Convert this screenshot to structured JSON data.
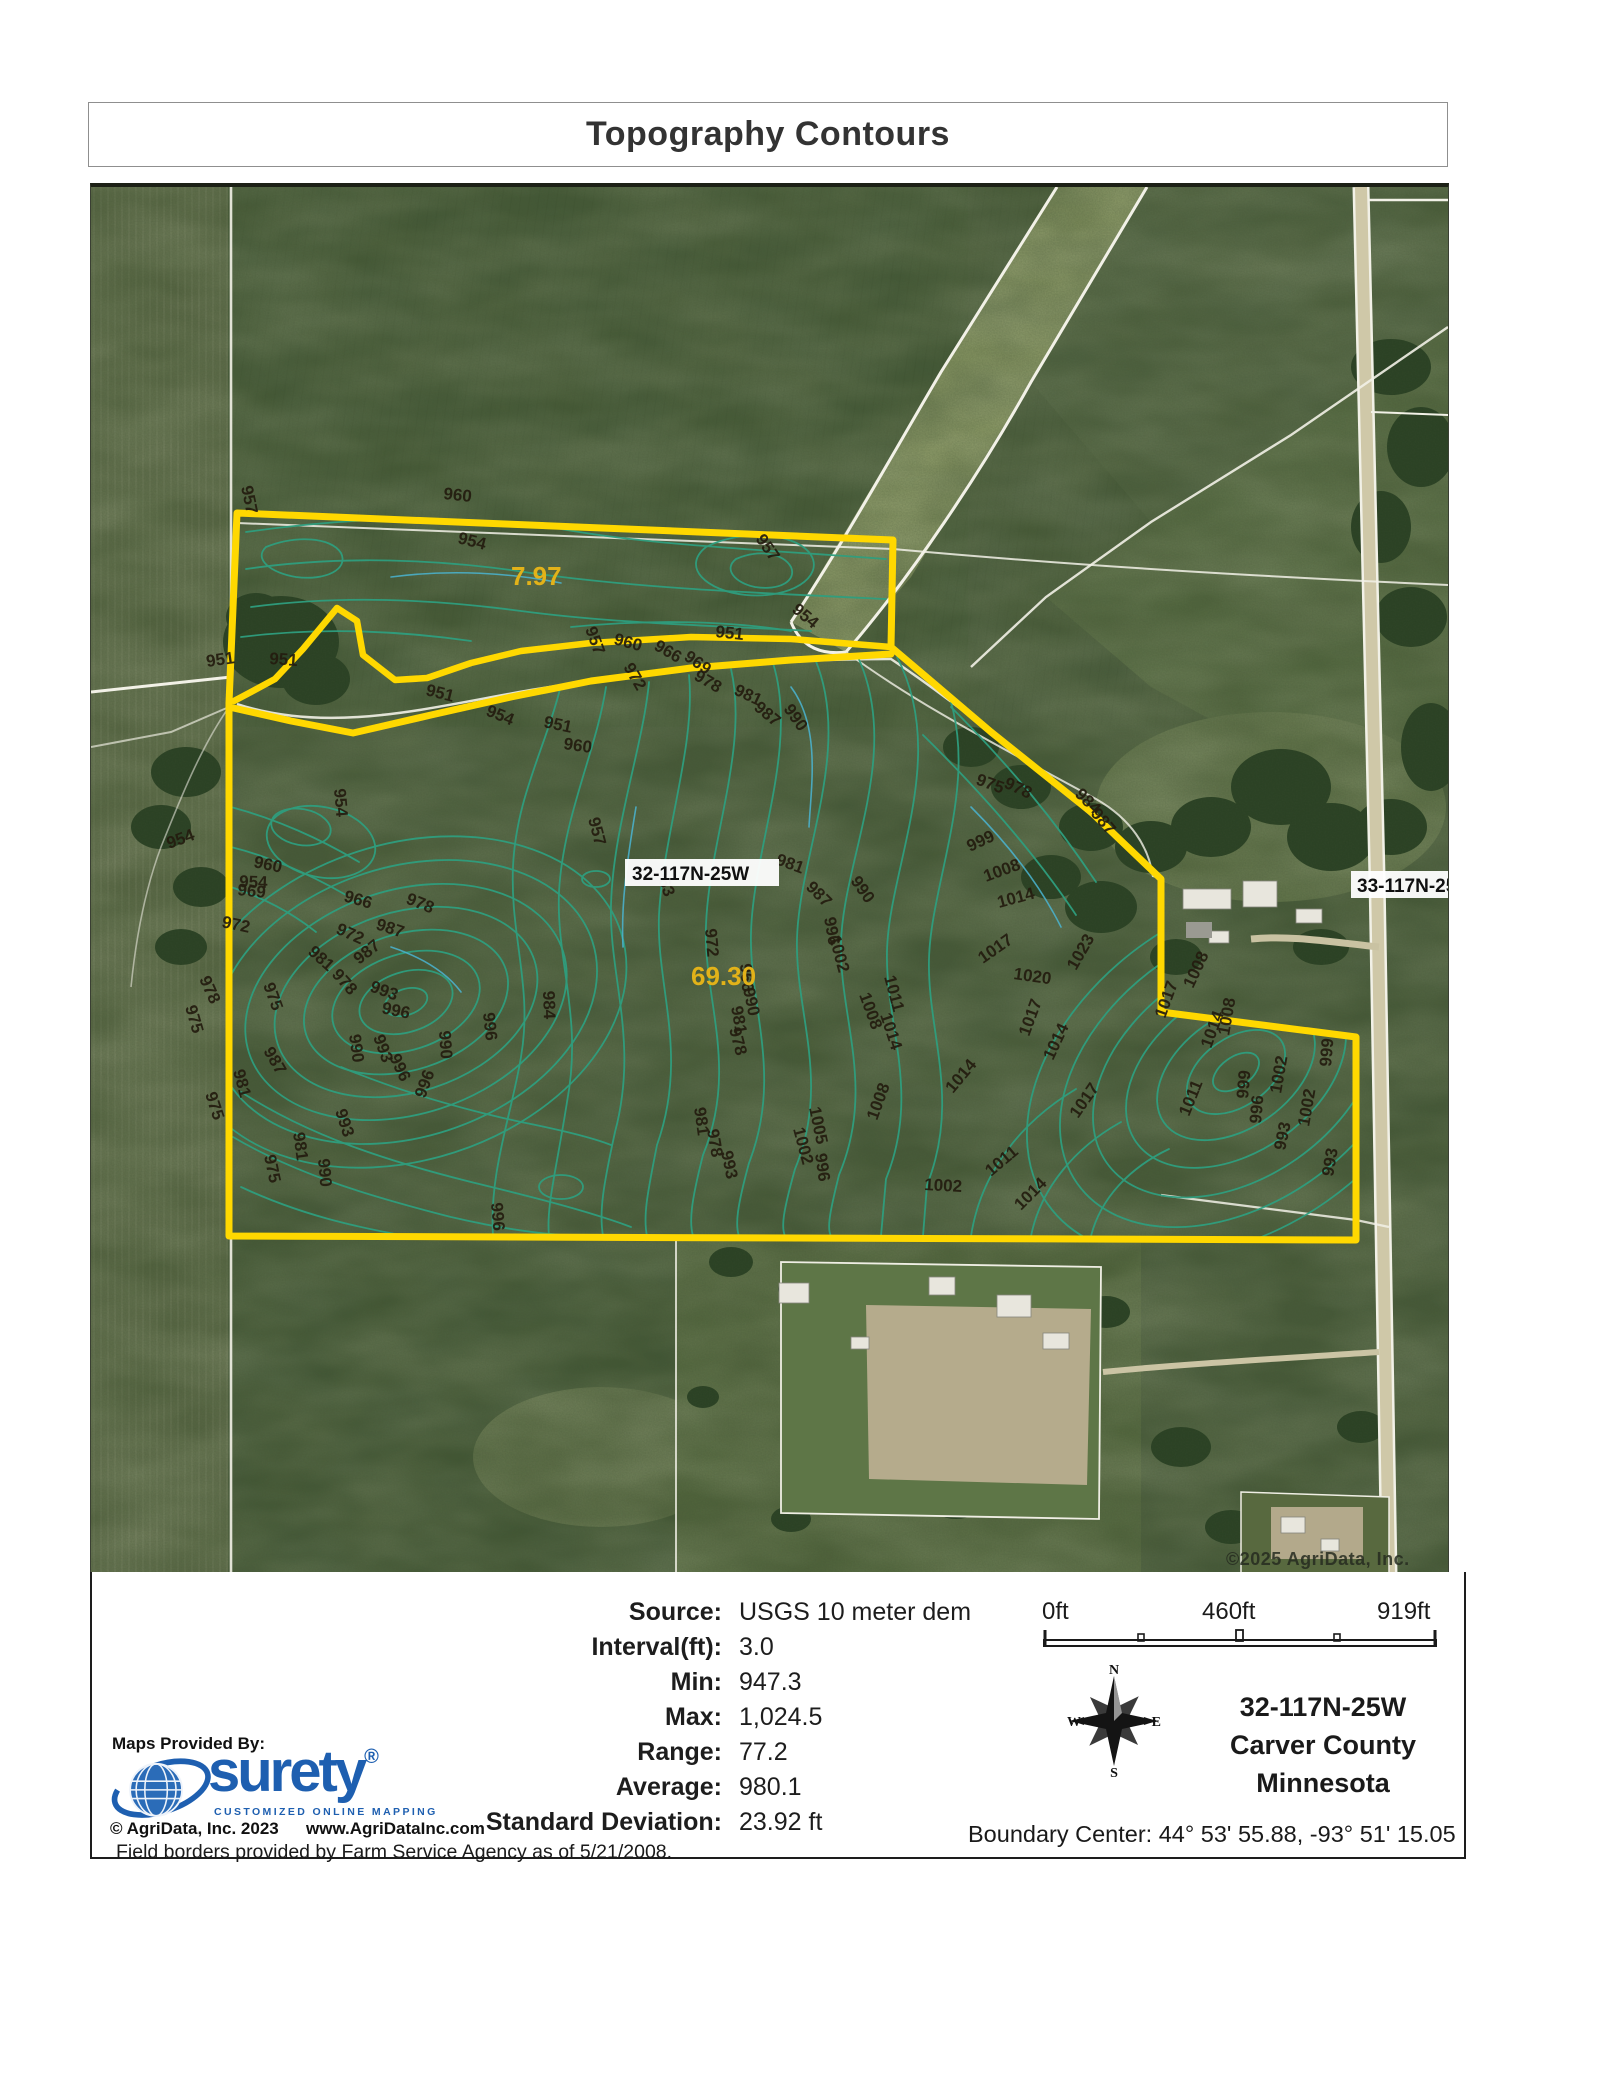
{
  "page": {
    "title": "Topography Contours"
  },
  "map": {
    "labels": {
      "township_left": "32-117N-25W",
      "township_right": "33-117N-25W",
      "copyright": "©2025 AgriData, Inc."
    },
    "parcels": [
      {
        "acres": "7.97"
      },
      {
        "acres": "69.30"
      }
    ],
    "contour_labels": [
      {
        "t": "957",
        "x": 150,
        "y": 300,
        "r": 78
      },
      {
        "t": "960",
        "x": 352,
        "y": 312,
        "r": 6
      },
      {
        "t": "954",
        "x": 366,
        "y": 356,
        "r": 14
      },
      {
        "t": "957",
        "x": 664,
        "y": 352,
        "r": 55
      },
      {
        "t": "954",
        "x": 700,
        "y": 424,
        "r": 40
      },
      {
        "t": "951",
        "x": 624,
        "y": 450,
        "r": 6
      },
      {
        "t": "951",
        "x": 116,
        "y": 480,
        "r": -8
      },
      {
        "t": "951",
        "x": 178,
        "y": 477,
        "r": 4
      },
      {
        "t": "951",
        "x": 334,
        "y": 508,
        "r": 14
      },
      {
        "t": "954",
        "x": 394,
        "y": 528,
        "r": 22
      },
      {
        "t": "951",
        "x": 452,
        "y": 540,
        "r": 12
      },
      {
        "t": "954",
        "x": 243,
        "y": 602,
        "r": 85
      },
      {
        "t": "954",
        "x": 148,
        "y": 700,
        "r": 2
      },
      {
        "t": "954",
        "x": 78,
        "y": 662,
        "r": -20
      },
      {
        "t": "960",
        "x": 162,
        "y": 680,
        "r": 12
      },
      {
        "t": "969",
        "x": 146,
        "y": 708,
        "r": 6
      },
      {
        "t": "972",
        "x": 130,
        "y": 740,
        "r": 12
      },
      {
        "t": "966",
        "x": 252,
        "y": 714,
        "r": 16
      },
      {
        "t": "978",
        "x": 314,
        "y": 716,
        "r": 22
      },
      {
        "t": "972",
        "x": 244,
        "y": 746,
        "r": 24
      },
      {
        "t": "987",
        "x": 284,
        "y": 742,
        "r": 18
      },
      {
        "t": "981",
        "x": 216,
        "y": 766,
        "r": 42
      },
      {
        "t": "978",
        "x": 240,
        "y": 788,
        "r": 48
      },
      {
        "t": "975",
        "x": 172,
        "y": 798,
        "r": 70
      },
      {
        "t": "987",
        "x": 268,
        "y": 778,
        "r": -38
      },
      {
        "t": "993",
        "x": 278,
        "y": 804,
        "r": 20
      },
      {
        "t": "996",
        "x": 290,
        "y": 826,
        "r": 12
      },
      {
        "t": "975",
        "x": 94,
        "y": 820,
        "r": 74
      },
      {
        "t": "978",
        "x": 108,
        "y": 792,
        "r": 66
      },
      {
        "t": "990",
        "x": 258,
        "y": 848,
        "r": 82
      },
      {
        "t": "993",
        "x": 282,
        "y": 850,
        "r": 70
      },
      {
        "t": "996",
        "x": 298,
        "y": 870,
        "r": 65
      },
      {
        "t": "984",
        "x": 452,
        "y": 804,
        "r": 88
      },
      {
        "t": "996",
        "x": 392,
        "y": 826,
        "r": 84
      },
      {
        "t": "990",
        "x": 348,
        "y": 844,
        "r": 86
      },
      {
        "t": "975",
        "x": 114,
        "y": 907,
        "r": 72
      },
      {
        "t": "981",
        "x": 142,
        "y": 884,
        "r": 75
      },
      {
        "t": "987",
        "x": 172,
        "y": 864,
        "r": 60
      },
      {
        "t": "996",
        "x": 334,
        "y": 912,
        "r": -70
      },
      {
        "t": "981",
        "x": 202,
        "y": 946,
        "r": 82
      },
      {
        "t": "975",
        "x": 173,
        "y": 969,
        "r": 78
      },
      {
        "t": "990",
        "x": 227,
        "y": 972,
        "r": 85
      },
      {
        "t": "993",
        "x": 244,
        "y": 924,
        "r": 72
      },
      {
        "t": "996",
        "x": 400,
        "y": 1016,
        "r": 85
      },
      {
        "t": "957",
        "x": 494,
        "y": 442,
        "r": 70
      },
      {
        "t": "960",
        "x": 522,
        "y": 457,
        "r": 15
      },
      {
        "t": "966",
        "x": 562,
        "y": 462,
        "r": 30
      },
      {
        "t": "969",
        "x": 592,
        "y": 472,
        "r": 35
      },
      {
        "t": "972",
        "x": 532,
        "y": 480,
        "r": 60
      },
      {
        "t": "978",
        "x": 602,
        "y": 492,
        "r": 30
      },
      {
        "t": "981",
        "x": 642,
        "y": 507,
        "r": 25
      },
      {
        "t": "987",
        "x": 662,
        "y": 522,
        "r": 40
      },
      {
        "t": "990",
        "x": 692,
        "y": 522,
        "r": 55
      },
      {
        "t": "963",
        "x": 564,
        "y": 684,
        "r": 70
      },
      {
        "t": "957",
        "x": 497,
        "y": 632,
        "r": 75
      },
      {
        "t": "960",
        "x": 472,
        "y": 562,
        "r": 8
      },
      {
        "t": "972",
        "x": 614,
        "y": 742,
        "r": 85
      },
      {
        "t": "996",
        "x": 733,
        "y": 731,
        "r": 80
      },
      {
        "t": "1002",
        "x": 738,
        "y": 750,
        "r": 75
      },
      {
        "t": "981",
        "x": 684,
        "y": 677,
        "r": 20
      },
      {
        "t": "987",
        "x": 714,
        "y": 701,
        "r": 45
      },
      {
        "t": "990",
        "x": 759,
        "y": 694,
        "r": 55
      },
      {
        "t": "966",
        "x": 649,
        "y": 777,
        "r": 85
      },
      {
        "t": "990",
        "x": 652,
        "y": 802,
        "r": 78
      },
      {
        "t": "981",
        "x": 640,
        "y": 820,
        "r": 80
      },
      {
        "t": "978",
        "x": 638,
        "y": 842,
        "r": 75
      },
      {
        "t": "975",
        "x": 884,
        "y": 597,
        "r": 20
      },
      {
        "t": "978",
        "x": 912,
        "y": 600,
        "r": 25
      },
      {
        "t": "984",
        "x": 983,
        "y": 608,
        "r": 45
      },
      {
        "t": "987",
        "x": 999,
        "y": 627,
        "r": 50
      },
      {
        "t": "999",
        "x": 879,
        "y": 665,
        "r": -25
      },
      {
        "t": "1008",
        "x": 895,
        "y": 695,
        "r": -20
      },
      {
        "t": "1014",
        "x": 908,
        "y": 721,
        "r": -15
      },
      {
        "t": "1011",
        "x": 793,
        "y": 790,
        "r": 75
      },
      {
        "t": "1008",
        "x": 768,
        "y": 808,
        "r": 70
      },
      {
        "t": "1014",
        "x": 789,
        "y": 828,
        "r": 72
      },
      {
        "t": "1017",
        "x": 892,
        "y": 777,
        "r": -35
      },
      {
        "t": "1020",
        "x": 922,
        "y": 792,
        "r": 8
      },
      {
        "t": "1023",
        "x": 985,
        "y": 784,
        "r": -60
      },
      {
        "t": "1017",
        "x": 938,
        "y": 850,
        "r": -70
      },
      {
        "t": "1014",
        "x": 962,
        "y": 874,
        "r": -65
      },
      {
        "t": "1005",
        "x": 718,
        "y": 921,
        "r": 78
      },
      {
        "t": "1002",
        "x": 702,
        "y": 942,
        "r": 75
      },
      {
        "t": "1008",
        "x": 786,
        "y": 934,
        "r": -70
      },
      {
        "t": "1014",
        "x": 862,
        "y": 907,
        "r": -50
      },
      {
        "t": "1002",
        "x": 833,
        "y": 1003,
        "r": 3
      },
      {
        "t": "996",
        "x": 724,
        "y": 967,
        "r": 82
      },
      {
        "t": "993",
        "x": 630,
        "y": 965,
        "r": 78
      },
      {
        "t": "978",
        "x": 616,
        "y": 943,
        "r": 80
      },
      {
        "t": "981",
        "x": 603,
        "y": 921,
        "r": 82
      },
      {
        "t": "1017",
        "x": 1074,
        "y": 832,
        "r": -70
      },
      {
        "t": "1008",
        "x": 1102,
        "y": 802,
        "r": -65
      },
      {
        "t": "1014",
        "x": 1120,
        "y": 862,
        "r": -70
      },
      {
        "t": "1008",
        "x": 1138,
        "y": 849,
        "r": -80
      },
      {
        "t": "999",
        "x": 1157,
        "y": 912,
        "r": -85
      },
      {
        "t": "996",
        "x": 1170,
        "y": 937,
        "r": -85
      },
      {
        "t": "1002",
        "x": 1190,
        "y": 907,
        "r": -80
      },
      {
        "t": "993",
        "x": 1194,
        "y": 964,
        "r": -78
      },
      {
        "t": "1011",
        "x": 1098,
        "y": 930,
        "r": -68
      },
      {
        "t": "1017",
        "x": 987,
        "y": 932,
        "r": -55
      },
      {
        "t": "1014",
        "x": 930,
        "y": 1024,
        "r": -45
      },
      {
        "t": "1011",
        "x": 900,
        "y": 990,
        "r": -40
      },
      {
        "t": "999",
        "x": 1240,
        "y": 880,
        "r": -85
      },
      {
        "t": "993",
        "x": 1242,
        "y": 990,
        "r": -80
      },
      {
        "t": "1002",
        "x": 1218,
        "y": 940,
        "r": -80
      }
    ]
  },
  "footer": {
    "stats": {
      "rows": [
        {
          "label": "Source:",
          "value": "USGS 10 meter dem"
        },
        {
          "label": "Interval(ft):",
          "value": "3.0"
        },
        {
          "label": "Min:",
          "value": "947.3"
        },
        {
          "label": "Max:",
          "value": "1,024.5"
        },
        {
          "label": "Range:",
          "value": "77.2"
        },
        {
          "label": "Average:",
          "value": "980.1"
        },
        {
          "label": "Standard Deviation:",
          "value": "23.92 ft"
        }
      ]
    },
    "scalebar": {
      "labels": [
        "0ft",
        "460ft",
        "919ft"
      ]
    },
    "compass": {
      "n": "N",
      "s": "S",
      "e": "E",
      "w": "W"
    },
    "location": {
      "township": "32-117N-25W",
      "county": "Carver County",
      "state": "Minnesota"
    },
    "boundary_center": "Boundary Center: 44° 53' 55.88, -93° 51' 15.05",
    "logo": {
      "provided_by": "Maps Provided By:",
      "brand": "surety",
      "registered": "®",
      "tagline": "CUSTOMIZED ONLINE MAPPING",
      "copyright": "© AgriData, Inc. 2023",
      "website": "www.AgriDataInc.com"
    },
    "field_borders_note": "Field borders provided by Farm Service Agency as of 5/21/2008."
  }
}
